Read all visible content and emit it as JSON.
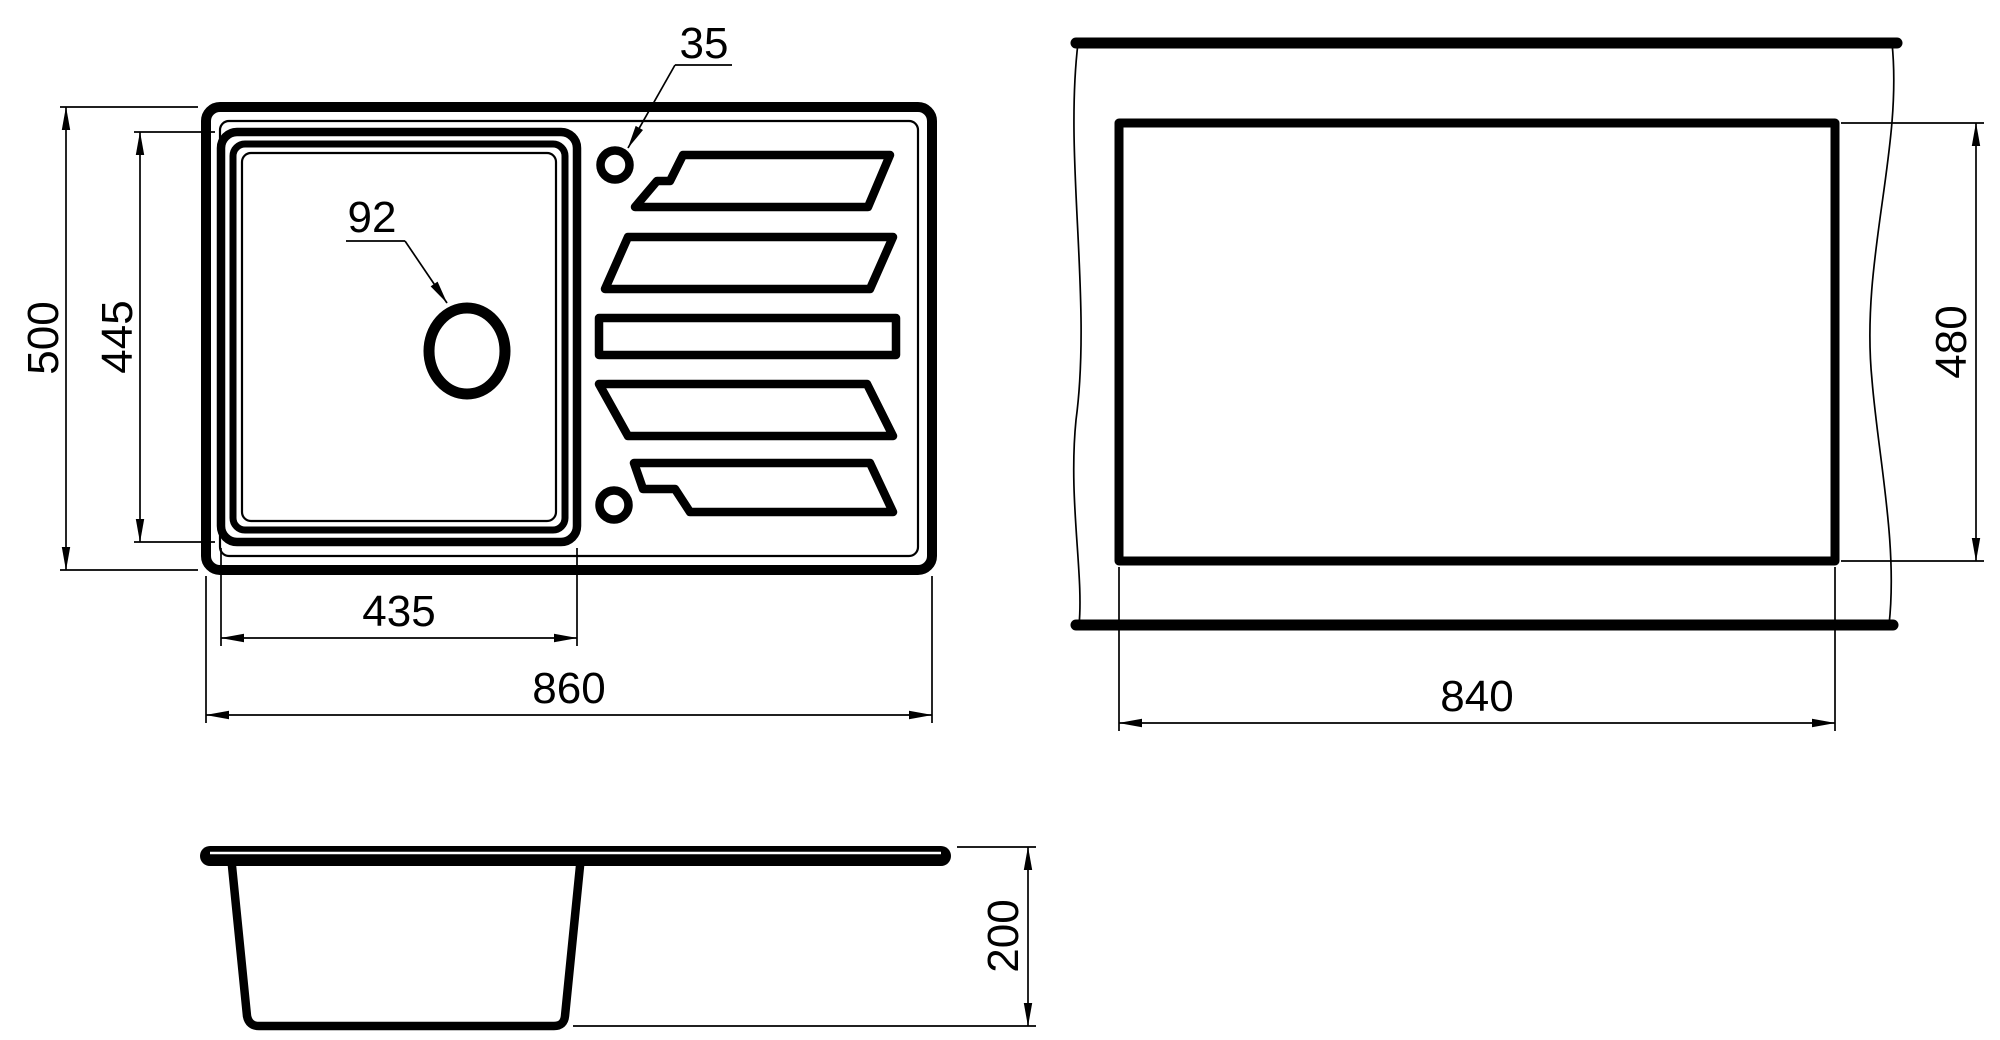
{
  "colors": {
    "line_color": "#000000",
    "background_color": "#ffffff"
  },
  "plan_view": {
    "dim_overall_height": "500",
    "dim_bowl_height": "445",
    "dim_bowl_width": "435",
    "dim_overall_width": "860",
    "drain_hole_label": "92",
    "tap_hole_label": "35"
  },
  "cutout_view": {
    "dim_width": "840",
    "dim_height": "480"
  },
  "side_view": {
    "dim_depth": "200"
  }
}
